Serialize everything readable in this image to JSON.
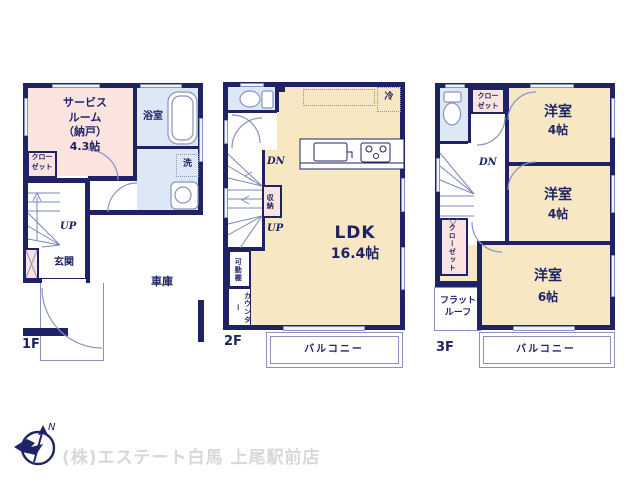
{
  "colors": {
    "wall": "#1f2366",
    "cream": "#f7e7c2",
    "pink": "#fbe3e0",
    "blue": "#dce8f5",
    "line": "#8a93bf",
    "footer": "#d8d8d8"
  },
  "f1": {
    "label": "1F",
    "service_room": "サービス\nルーム\n（納戸）\n4.3帖",
    "closet": "クロー\nゼット",
    "bath": "浴室",
    "wash": "洗",
    "up": "UP",
    "genkan": "玄関",
    "garage": "車庫"
  },
  "f2": {
    "label": "2F",
    "dn": "DN",
    "up": "UP",
    "storage": "収納",
    "movable_shelf": "可動棚",
    "counter": "カウンター",
    "ldk_name": "LDK",
    "ldk_size": "16.4帖",
    "fridge": "冷",
    "balcony": "バルコニー"
  },
  "f3": {
    "label": "3F",
    "dn": "DN",
    "closet_top": "クロー\nゼット",
    "closet_left": "クローゼット",
    "flat_roof": "フラット\nルーフ",
    "room1_name": "洋室",
    "room1_size": "4帖",
    "room2_name": "洋室",
    "room2_size": "4帖",
    "room3_name": "洋室",
    "room3_size": "6帖",
    "balcony": "バルコニー"
  },
  "footer": {
    "company": "(株)エステート白馬 上尾駅前店",
    "compass_label": "N"
  }
}
